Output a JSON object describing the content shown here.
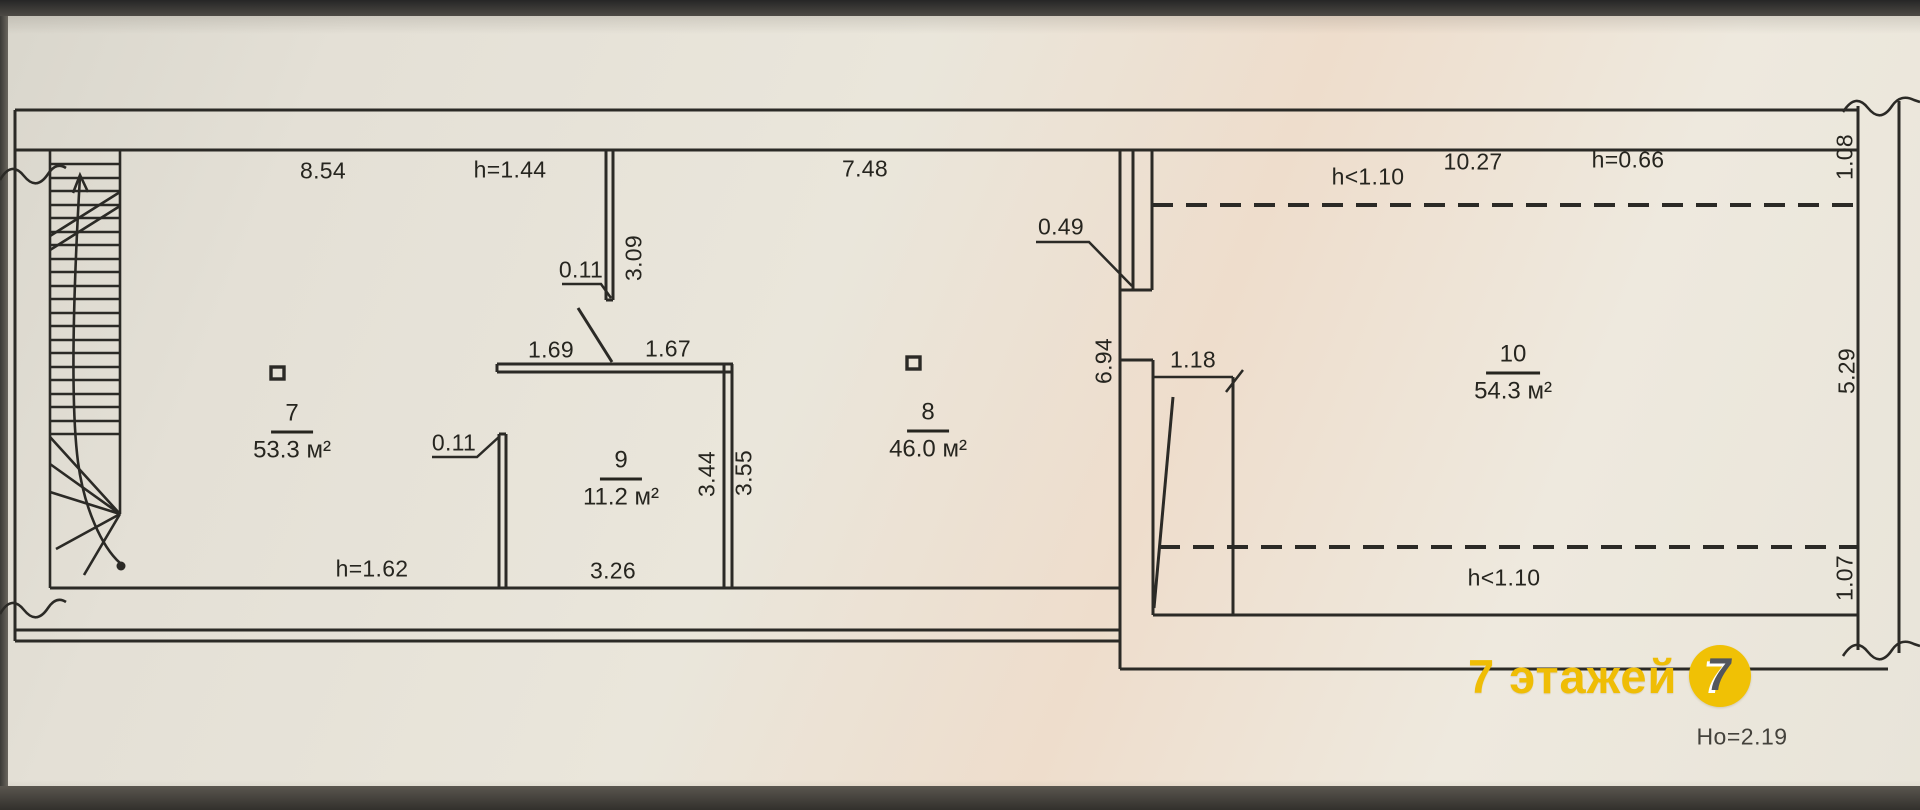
{
  "colors": {
    "ink": "#2b2a26",
    "paper": "#eae6db",
    "watermark_yellow": "#f0c105"
  },
  "rooms": [
    {
      "number": "7",
      "area": "53.3 м²"
    },
    {
      "number": "8",
      "area": "46.0 м²"
    },
    {
      "number": "9",
      "area": "11.2 м²"
    },
    {
      "number": "10",
      "area": "54.3 м²"
    }
  ],
  "dims": {
    "top_left_width": "8.54",
    "door_height": "h=1.44",
    "top_mid_width": "7.48",
    "recess_width": "0.49",
    "ceiling_limit_top": "h<1.10",
    "top_right_width": "10.27",
    "eaves_height": "h=0.66",
    "right_wall_seg_top": "1.08",
    "wall_offset_top": "0.11",
    "partition_length": "3.09",
    "opening_left": "1.69",
    "opening_right": "1.67",
    "mid_wall_length": "6.94",
    "opening_mid": "1.18",
    "right_wall_seg_mid": "5.29",
    "wall_offset_left": "0.11",
    "room9_inner_depth": "3.44",
    "room9_outer_depth": "3.55",
    "stair_headroom": "h=1.62",
    "room9_width": "3.26",
    "ceiling_limit_bottom": "h<1.10",
    "right_wall_seg_bottom": "1.07"
  },
  "watermark": {
    "text": "7 этажей",
    "logo_digit": "7"
  },
  "note": {
    "text": "Но=2.19"
  }
}
